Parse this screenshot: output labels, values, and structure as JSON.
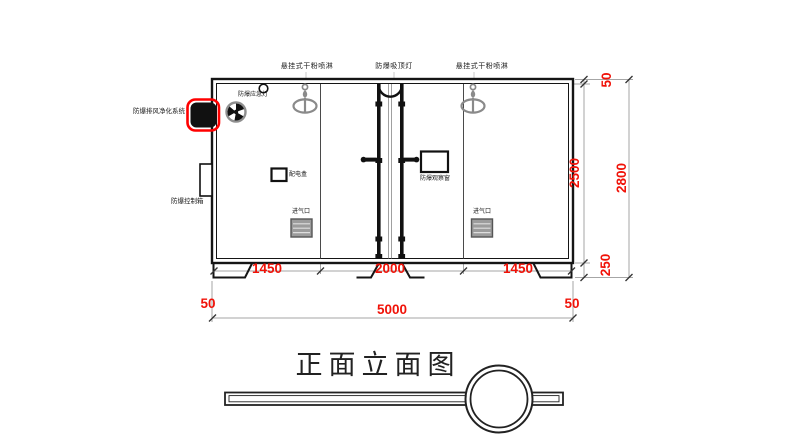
{
  "drawing": {
    "title": "正面立面图",
    "labels": {
      "sprinkler_left": "悬挂式干粉喷淋",
      "ceiling_lamp": "防爆吸顶灯",
      "sprinkler_right": "悬挂式干粉喷淋",
      "emergency_light": "防爆应急灯",
      "purification_system": "防爆排风净化系统",
      "control_box": "防爆控制箱",
      "power_box": "配电盒",
      "observation_window": "防爆观察窗",
      "air_inlet_left": "进气口",
      "air_inlet_right": "进气口"
    },
    "dimensions": {
      "bottom_inner": [
        "1450",
        "2000",
        "1450"
      ],
      "bottom_total": "5000",
      "bottom_left_offset": "50",
      "bottom_right_offset": "50",
      "right_top_offset": "50",
      "right_height": "2500",
      "right_base": "250",
      "right_total": "2800"
    },
    "colors": {
      "dimension_text": "#ff0000",
      "highlight_outline": "#ff0000",
      "main_line": "#1a1a1a",
      "secondary_line": "#9a9a9a",
      "sprinkler": "#8a8a8a",
      "vent_fill": "#9c9c9c"
    }
  }
}
